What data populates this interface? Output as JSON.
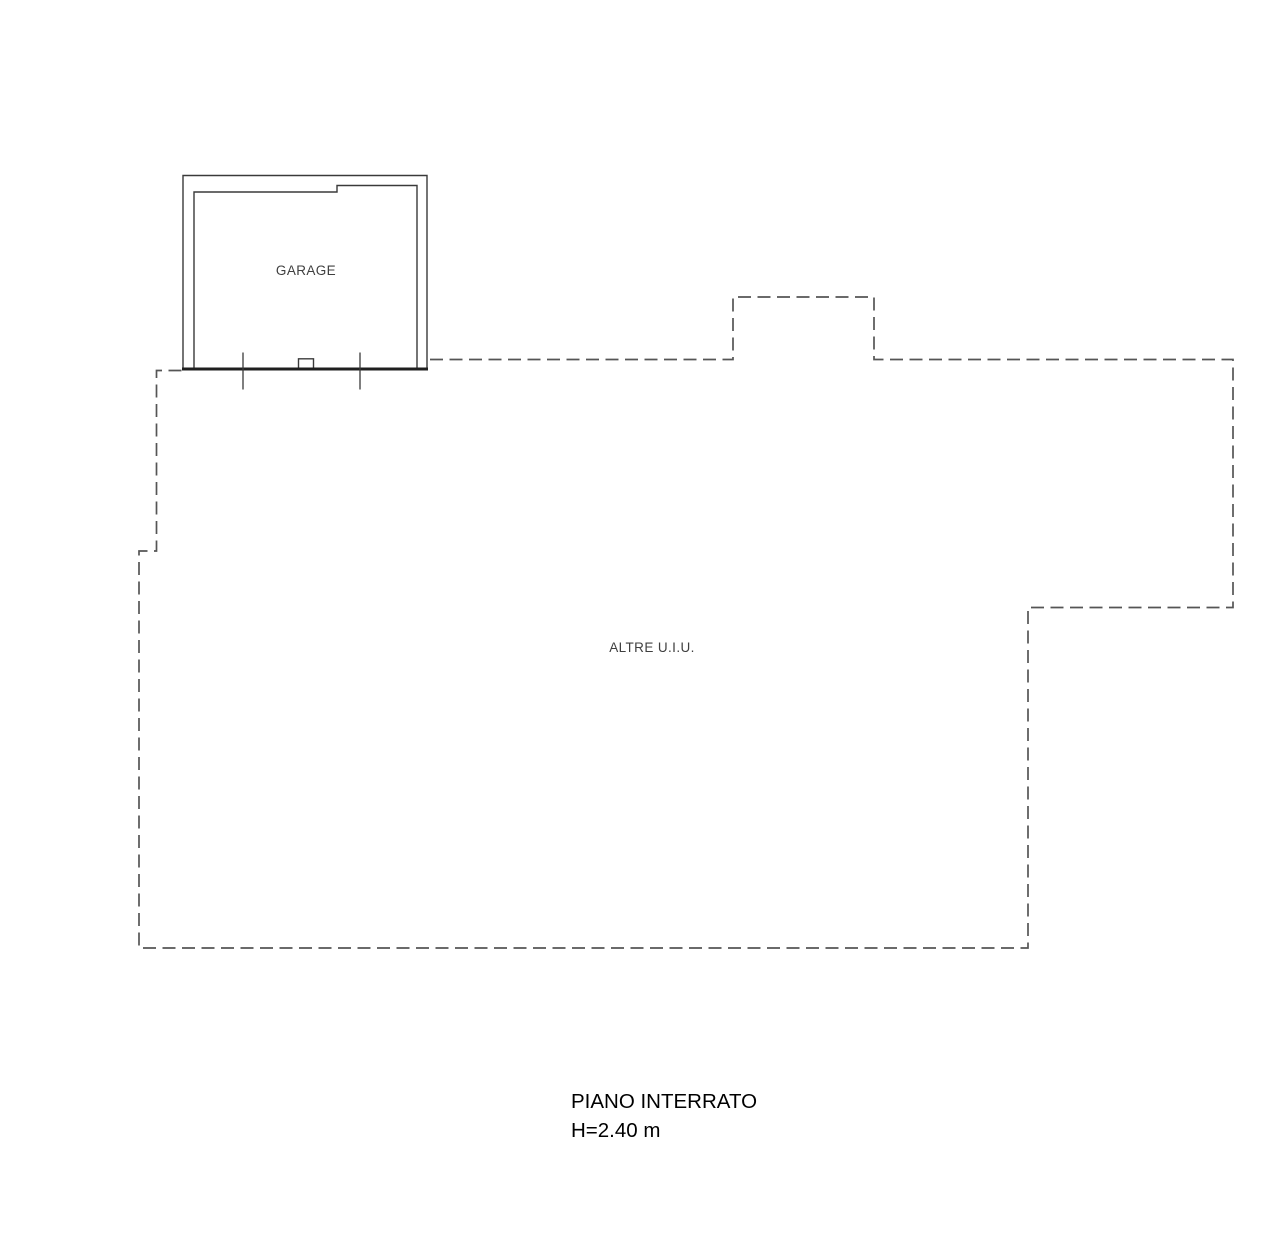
{
  "plan": {
    "rooms": {
      "garage": {
        "label": "GARAGE"
      },
      "altre": {
        "label": "ALTRE U.I.U."
      }
    },
    "footer": {
      "floor_label": "PIANO INTERRATO",
      "height_label": "H=2.40 m"
    },
    "colors": {
      "wall_solid": "#1f1f1f",
      "wall_thin": "#3a3a3a",
      "dashed_boundary": "#555555",
      "room_label_text": "#3f3f3f",
      "footer_text": "#000000",
      "background": "#ffffff"
    }
  }
}
